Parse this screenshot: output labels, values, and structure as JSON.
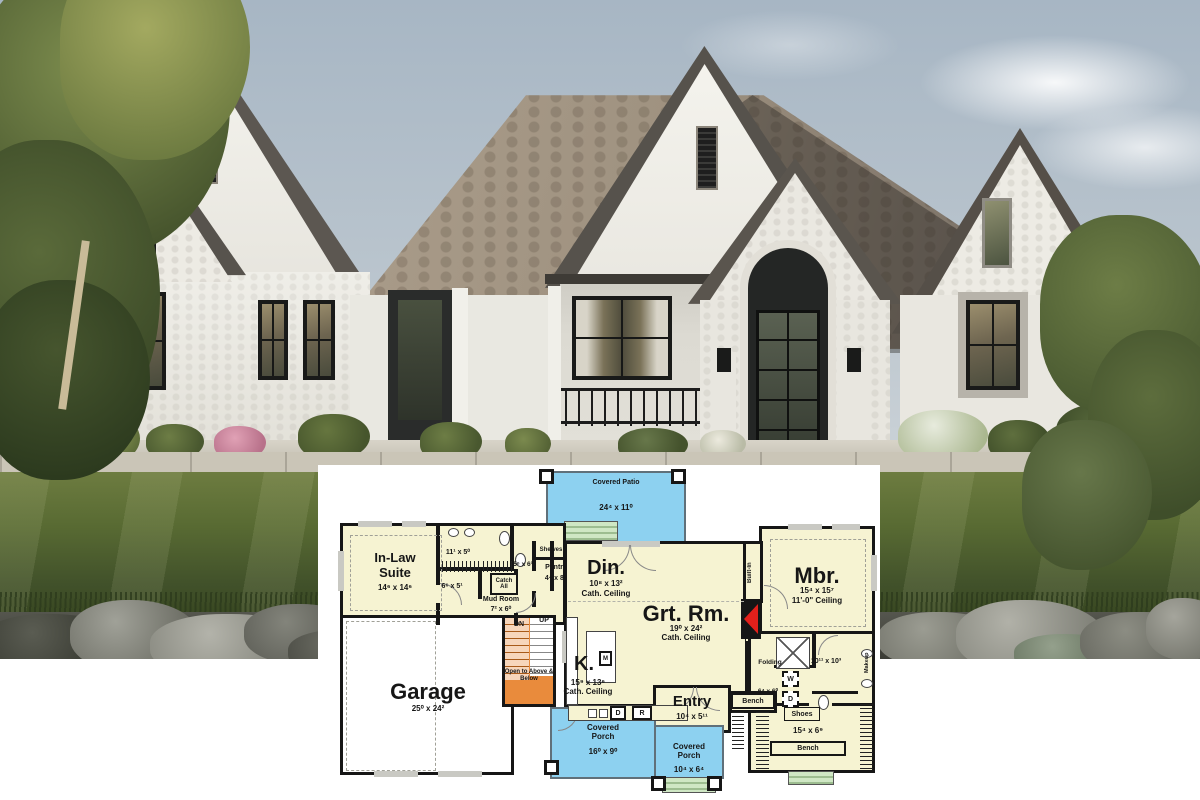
{
  "colors": {
    "plan_floor": "#f6f3d2",
    "plan_outdoor_blue": "#8dd1f0",
    "plan_stairs_orange": "#e98b3c",
    "plan_steps_green": "#cfe7c4",
    "plan_wall": "#161616",
    "fireplace_red": "#e3201b",
    "sky": "#b3c1cd",
    "roof_light": "#a89a88",
    "roof_shadow": "#635d56",
    "stucco_white": "#f0efe9",
    "lawn_green": "#5f7134",
    "rock_gray": "#87887f"
  },
  "floor_plan": {
    "covered_patio": {
      "label": "Covered Patio",
      "dims": "24⁴ x 11⁰"
    },
    "in_law_suite": {
      "label": "In-Law Suite",
      "dims": "14⁶ x 14⁶"
    },
    "in_law_bath": {
      "dims": "11¹ x 5⁰"
    },
    "in_law_closet": {
      "dims": "6⁶ x 5¹"
    },
    "mud_room": {
      "label": "Mud Room",
      "dims": "7² x 6⁰"
    },
    "catch_all": {
      "label": "Catch All"
    },
    "shelves": {
      "label": "Shelves"
    },
    "powder": {
      "dims": "5⁶ x 6³"
    },
    "pantry": {
      "label": "Pantry",
      "dims": "4⁴ x 8⁵"
    },
    "dining": {
      "label": "Din.",
      "dims": "10⁸ x 13²",
      "ceiling": "Cath. Ceiling"
    },
    "great_room": {
      "label": "Grt. Rm.",
      "dims": "19⁰ x 24²",
      "ceiling": "Cath. Ceiling"
    },
    "built_in": {
      "label": "Built-In"
    },
    "master": {
      "label": "Mbr.",
      "dims": "15⁴ x 15⁷",
      "ceiling": "11'-0\" Ceiling"
    },
    "garage": {
      "label": "Garage",
      "dims": "25⁰ x 24²"
    },
    "stairs": {
      "down": "DN",
      "up": "UP",
      "note": "Open to Above & Below"
    },
    "kitchen": {
      "label": "K.",
      "dims": "15⁹ x 13⁶",
      "ceiling": "Cath. Ceiling",
      "microwave": "M",
      "dishwasher": "D",
      "range": "R"
    },
    "entry": {
      "label": "Entry",
      "dims": "10⁴ x 5¹¹"
    },
    "entry_bench": {
      "label": "Bench"
    },
    "covered_porch_front": {
      "label": "Covered Porch",
      "dims": "16⁰ x 9⁰"
    },
    "covered_porch_side": {
      "label": "Covered Porch",
      "dims": "10⁴ x 6⁴"
    },
    "laundry": {
      "label": "Folding",
      "dims": "6⁴ x 6⁰",
      "washer": "W",
      "dryer": "D"
    },
    "master_bath": {
      "dims": "10¹¹ x 10³",
      "makeup": "Makeup"
    },
    "master_closet": {
      "dims": "15⁴ x 6⁹",
      "shoes": "Shoes",
      "bench": "Bench"
    }
  }
}
